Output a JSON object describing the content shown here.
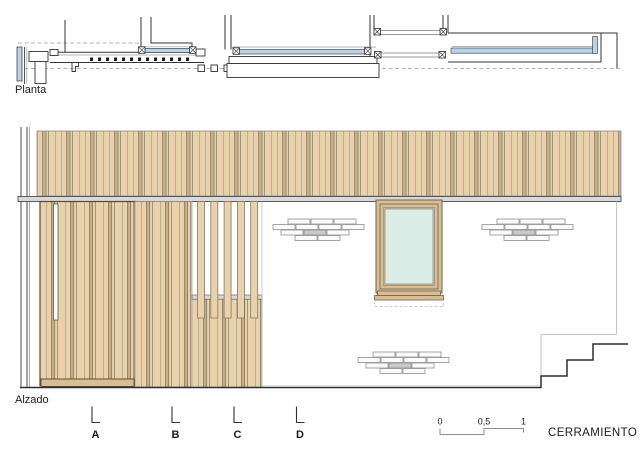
{
  "plan": {
    "label": "Planta"
  },
  "elevation": {
    "label": "Alzado"
  },
  "section_marks": {
    "labels": [
      "A",
      "B",
      "C",
      "D"
    ]
  },
  "scale_bar": {
    "ticks": [
      "0",
      "0,5",
      "1"
    ]
  },
  "title_block": {
    "label": "CERRAMIENTO"
  },
  "colors": {
    "wood": "#e8d1ab",
    "wood_dark": "#c9ae84",
    "frame": "#d9bd93",
    "glass": "#daeee7",
    "glazing": "#b8d2e8",
    "divider": "#d8d8d8",
    "brick": "#fbfbfb"
  }
}
